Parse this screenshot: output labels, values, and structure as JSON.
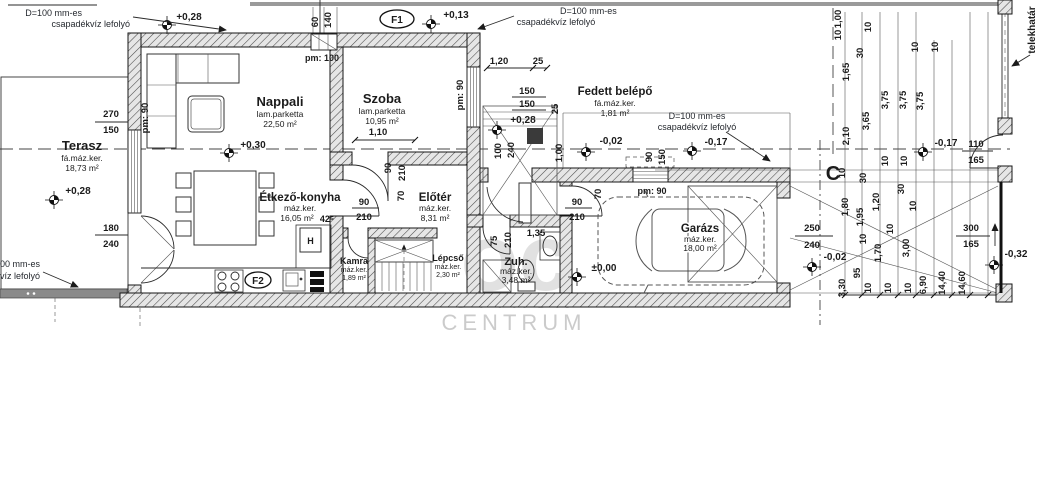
{
  "watermark": {
    "logo": "oc",
    "line1": "OTTHON",
    "line2": "CENTRUM"
  },
  "labels": {
    "drain_l1": "D=100 mm-es",
    "drain_l2": "csapadékvíz lefolyó",
    "telekhatar": "telekhatár",
    "section_c": "C",
    "f1": "F1",
    "f2": "F2",
    "fridge": "H",
    "note425": "42⁵",
    "pm100": "pm: 100",
    "pm90": "pm: 90"
  },
  "rooms": {
    "terasz": {
      "name": "Terasz",
      "finish": "fá.máz.ker.",
      "area": "18,73 m²"
    },
    "nappali": {
      "name": "Nappali",
      "finish": "lam.parketta",
      "area": "22,50 m²"
    },
    "szoba": {
      "name": "Szoba",
      "finish": "lam.parketta",
      "area": "10,95 m²"
    },
    "fedett": {
      "name": "Fedett belépő",
      "finish": "fá.máz.ker.",
      "area": "1,81 m²"
    },
    "etkezo": {
      "name": "Étkező-konyha",
      "finish": "máz.ker.",
      "area": "16,05 m²"
    },
    "eloter": {
      "name": "Előtér",
      "finish": "máz.ker.",
      "area": "8,31 m²"
    },
    "kamra": {
      "name": "Kamra",
      "finish": "máz.ker.",
      "area": "1,89 m²"
    },
    "lepcso": {
      "name": "Lépcső",
      "finish": "máz.ker.",
      "area": "2,30 m²"
    },
    "zuh": {
      "name": "Zuh.",
      "finish": "máz.ker.",
      "area": "3,48 m²"
    },
    "garazs": {
      "name": "Garázs",
      "finish": "máz.ker.",
      "area": "18,00 m²"
    }
  },
  "levels": {
    "eave": "+0,28",
    "terasz": "+0,28",
    "nappali": "+0,30",
    "szoba_roof": "+0,13",
    "entry": "+0,28",
    "porch": "-0,02",
    "porch_corner": "-0,17",
    "garage": "±0,00",
    "drive": "-0,02",
    "gate": "-0,17",
    "street": "-0,32"
  },
  "openings": {
    "terrace_window": {
      "w": "270",
      "h": "150"
    },
    "terrace_door": {
      "w": "180",
      "h": "240"
    },
    "vent": {
      "w": "60",
      "h": "140"
    },
    "szoba_window": {
      "w": "150",
      "h": "150",
      "a": "1,20",
      "b": "25"
    },
    "szoba_door": {
      "w": "90",
      "h": "210",
      "off": "1,10"
    },
    "kitchen_door": {
      "w": "90",
      "h": "210",
      "off": "70"
    },
    "garage_door": {
      "w": "90",
      "h": "210",
      "off": "70"
    },
    "shower_door": {
      "w": "75",
      "h": "210",
      "off": "1,35"
    },
    "front_door": {
      "w": "100",
      "h": "240",
      "a": "1,00",
      "b": "25"
    },
    "garage_window": {
      "w": "90",
      "h": "150"
    },
    "garage_gate": {
      "w": "250",
      "h": "240"
    },
    "gate_door": {
      "w": "110",
      "h": "165"
    },
    "street_gate": {
      "w": "300",
      "h": "165"
    }
  },
  "chains": {
    "top": [
      "1,00",
      "10",
      "1,65",
      "2,10",
      "30",
      "10",
      "3,65",
      "3,75",
      "3,75",
      "3,75",
      "10",
      "10",
      "10",
      "10"
    ],
    "drive": [
      "1,80",
      "1,95",
      "1,20",
      "30",
      "10",
      "1,70",
      "95",
      "10",
      "30",
      "10",
      "3,00",
      "10"
    ],
    "bottom": [
      "3,30",
      "10",
      "10",
      "10",
      "6,90",
      "14,40",
      "14,60"
    ]
  }
}
